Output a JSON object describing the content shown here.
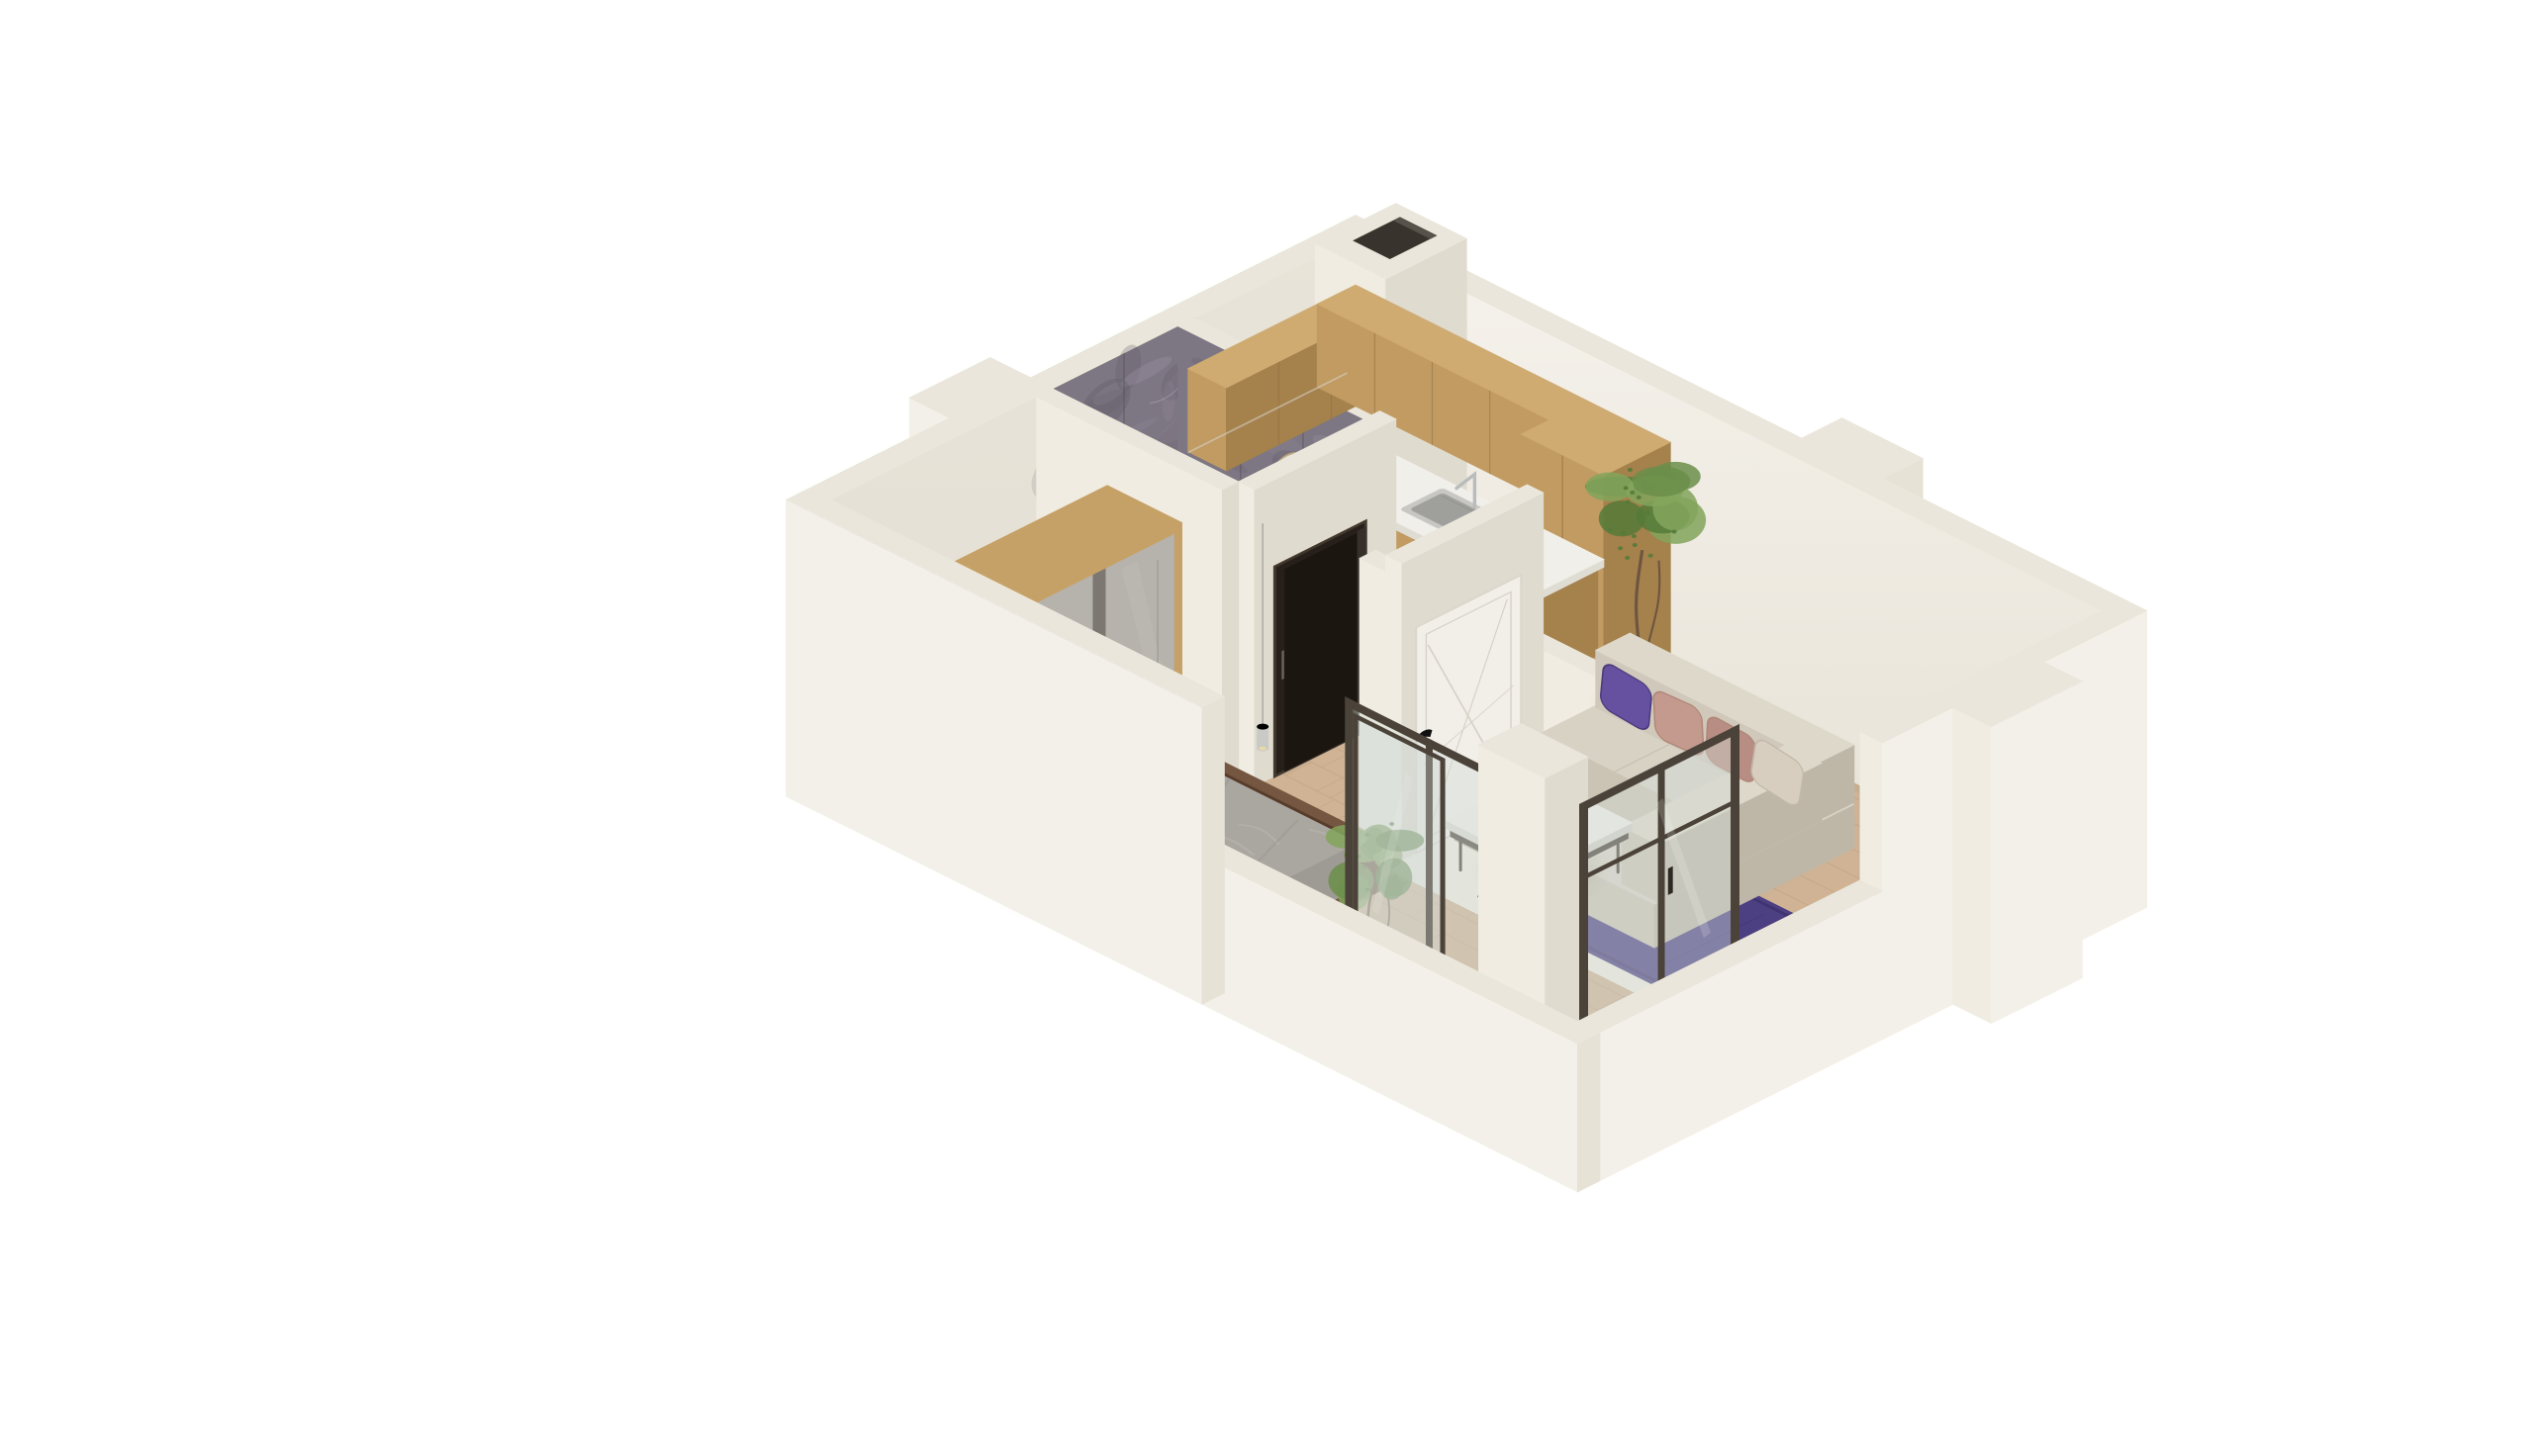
{
  "title": "Isometric 3D cutaway floor plan of a one-bedroom apartment",
  "background": "#ffffff",
  "view": {
    "projection": "isometric",
    "presentation": "open-top cutaway render"
  },
  "palette": {
    "wallTop": "#eae6db",
    "wallSW": "#f0ece1",
    "wallSE": "#e0dbcf",
    "wallOuter": "#f3f0e9",
    "wallOuterShade": "#e7e2d6",
    "wallInnerA": "#f6f3ed",
    "wallInnerB": "#e6e1d5",
    "wallNWFace": "#e3ded3",
    "floorWood": "#cfb394",
    "plankLine": "#b2967a",
    "floorBath": "#b9b5b0",
    "bathGrid": "#a7a39e",
    "floorBalcony": "#b8b7b2",
    "balconySpeck": "#9d9c97",
    "tile": "#7d7683",
    "tileLight": "#9b93a3",
    "tileDark": "#615a66",
    "grout": "#554f5a",
    "vein": "#cfc9d4",
    "oakTop": "#cfab72",
    "oakFront": "#c19b61",
    "oakSide": "#a5814c",
    "oakSeam": "#8f6f42",
    "counterTop": "#f1efe9",
    "counterSide": "#dfdcd4",
    "cooktop": "#1b1917",
    "steel": "#c8c7c3",
    "steelDark": "#9fa09c",
    "chrome": "#b9bcbd",
    "rug": "#4c3f82",
    "rugDark": "#3f3470",
    "mat": "#b3a99c",
    "sofaTop": "#d8d2c5",
    "sofaFront": "#cbc4b5",
    "sofaSide": "#beb7a8",
    "sofaBackTop": "#ded8cb",
    "sofaBackFace": "#d0c9bb",
    "pillowPurple": "#65519f",
    "pillowPurpleDark": "#4a3a7d",
    "pillowPink": "#c49a8e",
    "pillowPinkDark": "#b18778",
    "pillowBeige": "#d7cec0",
    "duvet": "#aaa6a0",
    "duvetHi": "#bcb8b2",
    "duvetShade": "#94908a",
    "sheet": "#e7e5e0",
    "bedSide": "#9e9a94",
    "bedFrame": "#6b4e3a",
    "bedFrameDark": "#553c2b",
    "bedFrameTop": "#755641",
    "wardWood": "#c6a167",
    "wardWoodSide": "#a5814c",
    "wardDoor": "#b6b2ac",
    "wardGap": "#7c7871",
    "doorWhite": "#f2efe8",
    "doorGroove": "#d6d2c8",
    "doorDark": "#261f1a",
    "doorDarkFrame": "#42382e",
    "doorDarkInner": "#1c1611",
    "glassFrame": "#4b4339",
    "glass": "#d3dcd8",
    "green1": "#82a55c",
    "green2": "#6b8e4a",
    "green3": "#557a38",
    "trunk": "#6d553f",
    "potWhite": "#eceae3",
    "potClay": "#cdc7b9",
    "pendant": "#9a9a97",
    "shadow": "#6f6657"
  },
  "scene": {
    "type": "isometric-3d-floor-plan",
    "rooms": [
      {
        "name": "kitchen",
        "floor": "wood",
        "features": [
          "l-shaped-oak-cabinets",
          "upper-cabinets",
          "tall-cabinet",
          "white-countertop",
          "steel-sink",
          "faucet",
          "black-cooktop",
          "decor-plate",
          "vent-shaft"
        ]
      },
      {
        "name": "living-room",
        "floor": "wood",
        "features": [
          "beige-corner-sofa",
          "purple-and-pink-pillows",
          "purple-rug",
          "marble-coffee-table",
          "table-sprig",
          "potted-plant",
          "corner-glass-door"
        ]
      },
      {
        "name": "bedroom",
        "floor": "wood",
        "features": [
          "double-bed",
          "gray-duvet",
          "purple-pillows",
          "dark-wood-bed-frame",
          "glass-nightstand",
          "wardrobe-oak-frame-gray-doors",
          "pendant-lamps",
          "sliding-glass-door"
        ]
      },
      {
        "name": "bathroom",
        "floor": "gray-tile",
        "features": [
          "gray-marble-tiled-walls",
          "shower-tray",
          "glass-shower-screen",
          "dark-brown-door"
        ]
      },
      {
        "name": "entry-hall",
        "floor": "wood",
        "features": [
          "white-entrance-door-x-pattern",
          "black-door-handle",
          "doormat"
        ]
      },
      {
        "name": "balcony",
        "floor": "concrete",
        "features": [
          "low-parapet-walls",
          "potted-plant",
          "dark-framed-sliding-doors",
          "white-pier-block"
        ]
      }
    ],
    "exterior": [
      "cream-cut-walls",
      "wall-pillar-notches",
      "white-background"
    ]
  }
}
